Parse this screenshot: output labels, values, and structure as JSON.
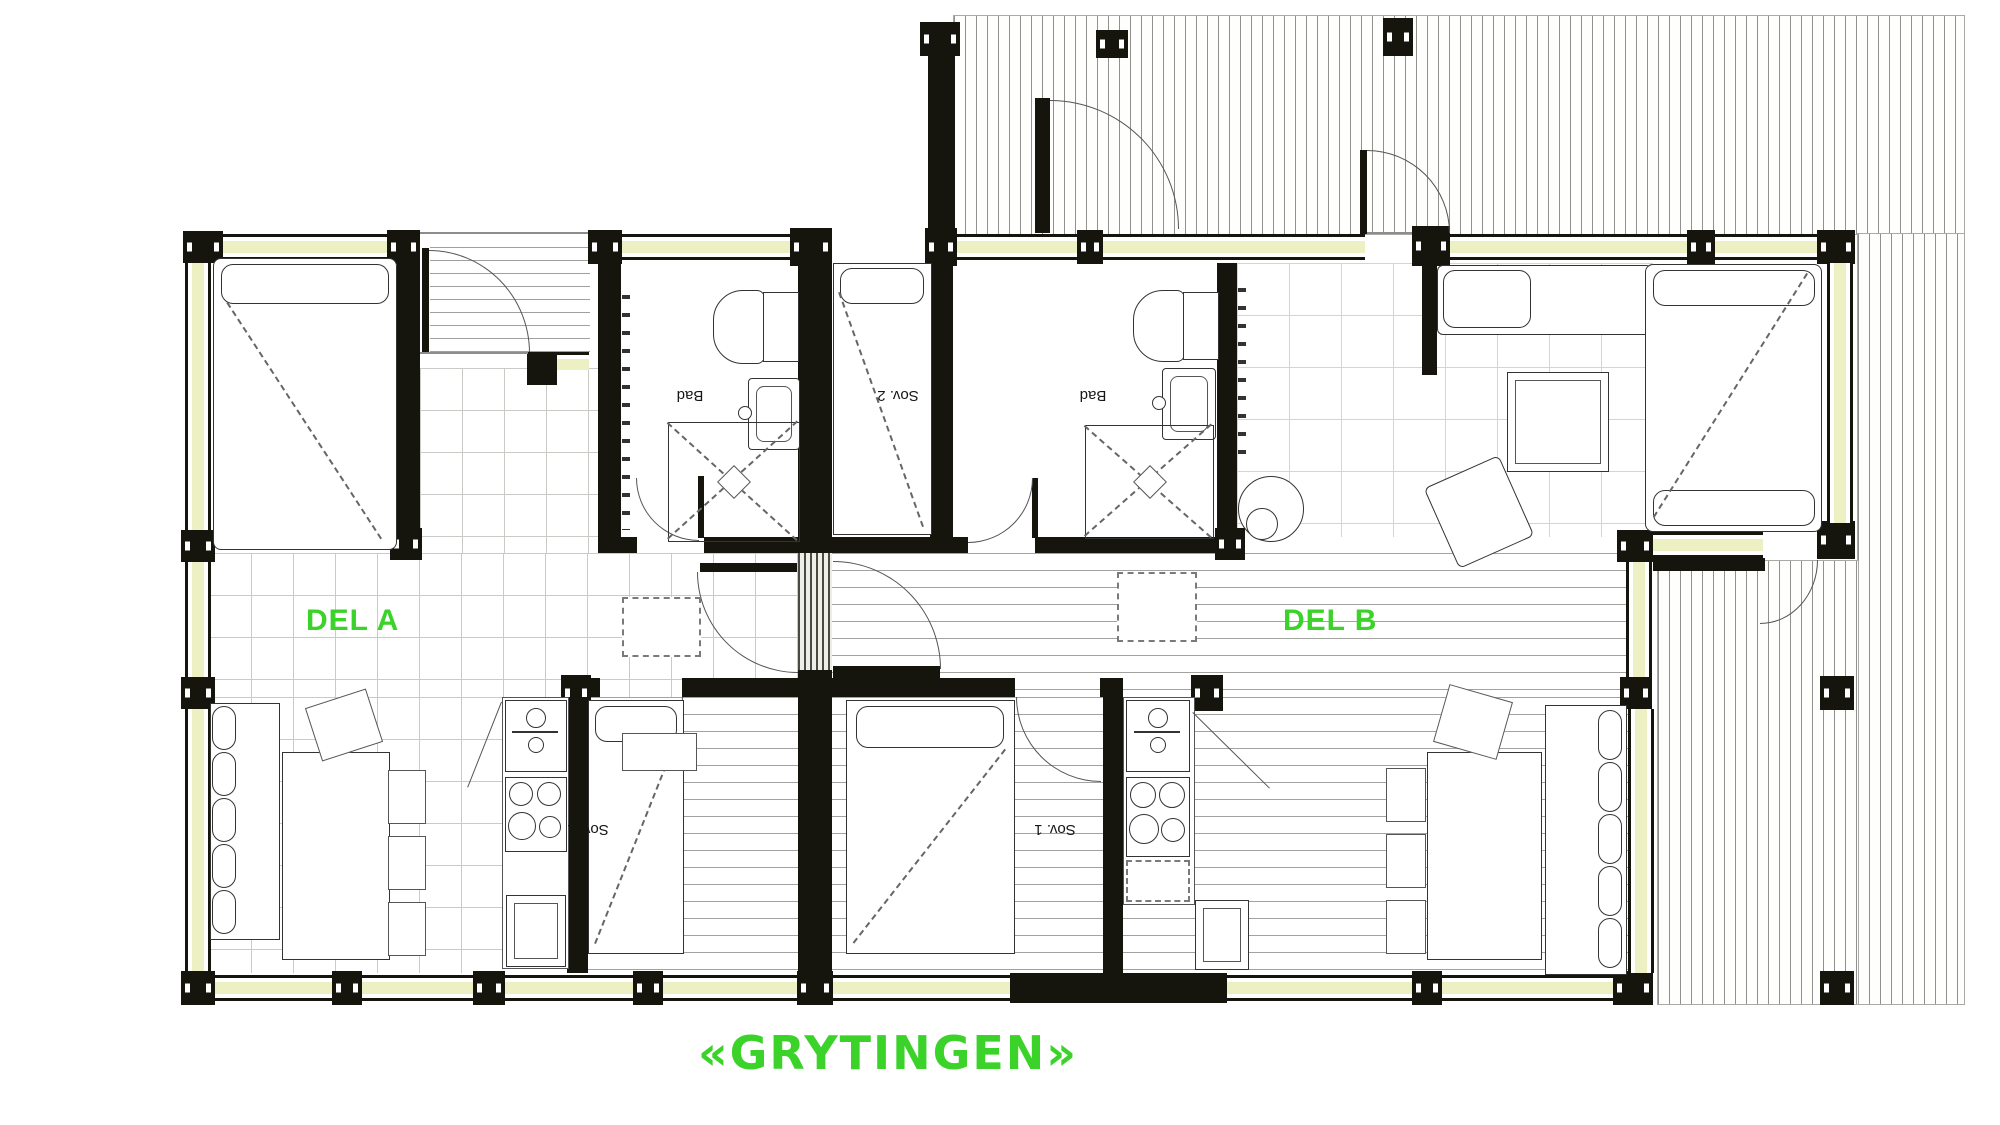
{
  "title": {
    "text": "«GRYTINGEN»"
  },
  "units": [
    {
      "id": "A",
      "label": "DEL A"
    },
    {
      "id": "B",
      "label": "DEL B"
    }
  ],
  "room_labels": {
    "bad_a": "Bad",
    "sov2_a": "Sov. 2",
    "bad_b": "Bad",
    "sov1_a": "Sov. 1",
    "sov1_b": "Sov. 1"
  },
  "colors": {
    "label_green": "#3bd32a",
    "wall_black": "#15150d",
    "window_fill": "#edf0c2",
    "deck_line": "#90908c",
    "tile_line": "#c6c6c2"
  }
}
